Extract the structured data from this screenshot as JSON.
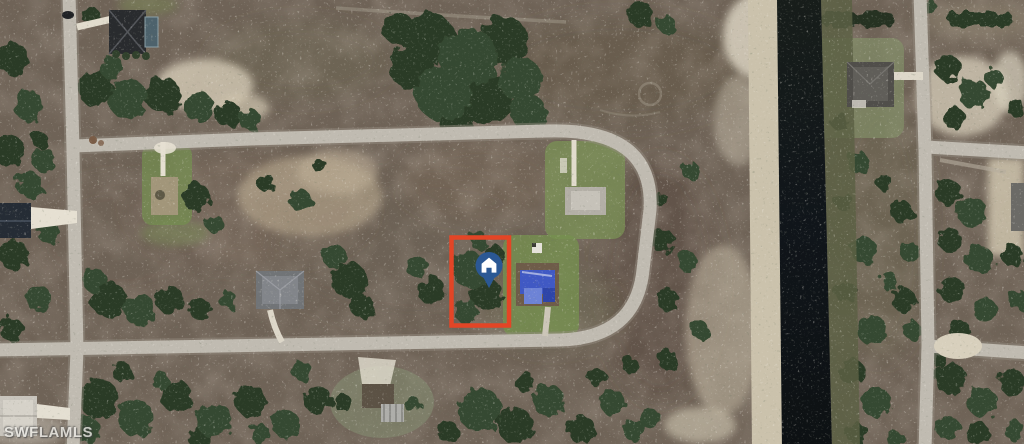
{
  "map": {
    "watermark": "SWFLAMLS"
  },
  "lot_highlight": {
    "shape": "rectangle",
    "color": "#e34526"
  },
  "marker": {
    "icon": "home-marker-icon",
    "background_color": "#2b5894",
    "glyph_color": "#ffffff"
  }
}
